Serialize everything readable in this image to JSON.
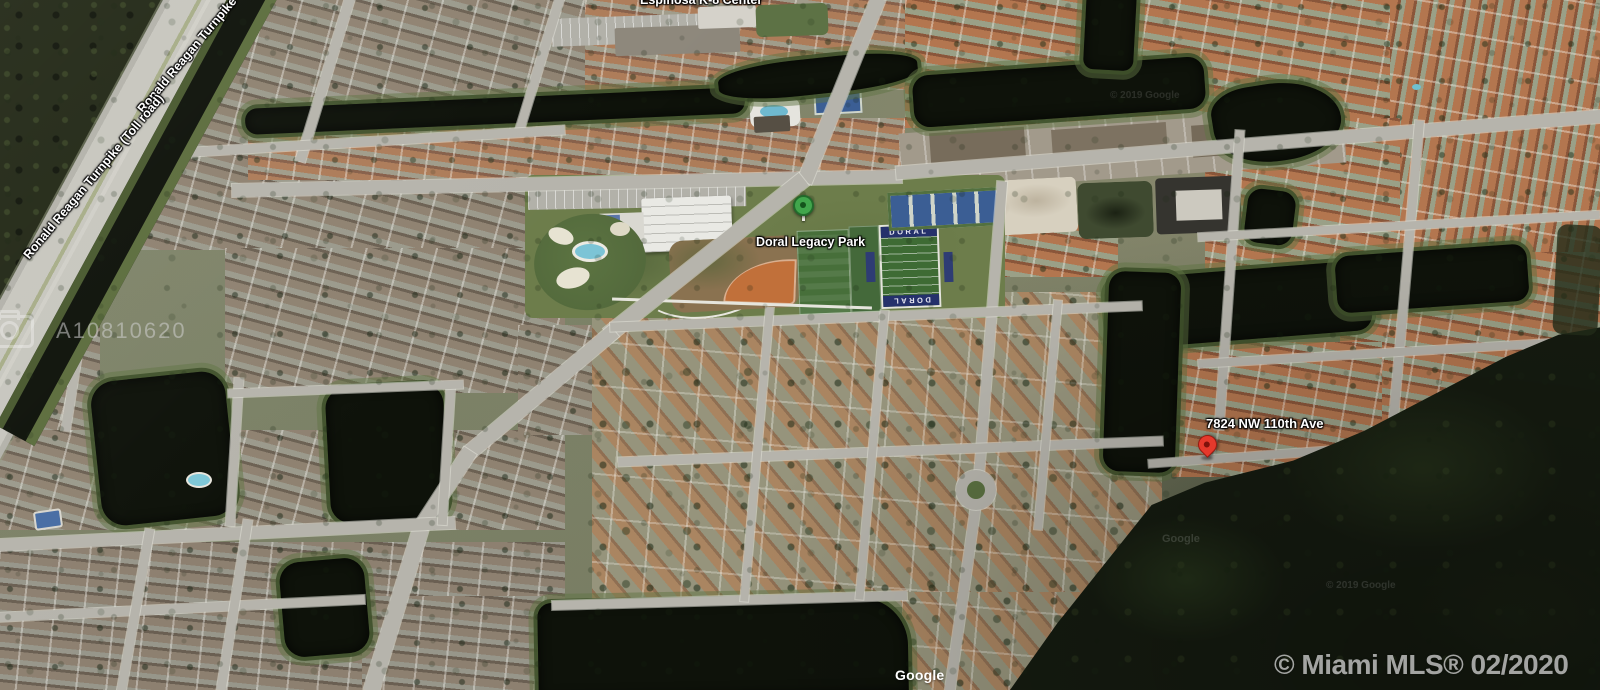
{
  "map": {
    "type": "satellite-aerial-photo",
    "location_labels": {
      "school": "Espinosa K-8 Center",
      "turnpike_upper": "Ronald Reagan Turnpike",
      "turnpike_lower": "Ronald Reagan Turnpike (Toll road)",
      "park": "Doral Legacy Park",
      "football_end_zone": "DORAL",
      "address": "7824 NW 110th Ave"
    },
    "watermarks": {
      "listing_id": "A10810620",
      "brand": "© Miami MLS® 02/2020",
      "google": "Google",
      "google_faint": "Google",
      "google_copyright": "© 2019 Google"
    },
    "colors": {
      "pin_red": "#e5392c",
      "pin_green": "#41a64c",
      "water": "#0e120a",
      "field_green": "#3e6b34",
      "end_zone_blue": "#25316b",
      "court_blue": "#3b5e94",
      "infield_orange": "#c1703a",
      "road_gray": "#b6b4ac"
    }
  }
}
